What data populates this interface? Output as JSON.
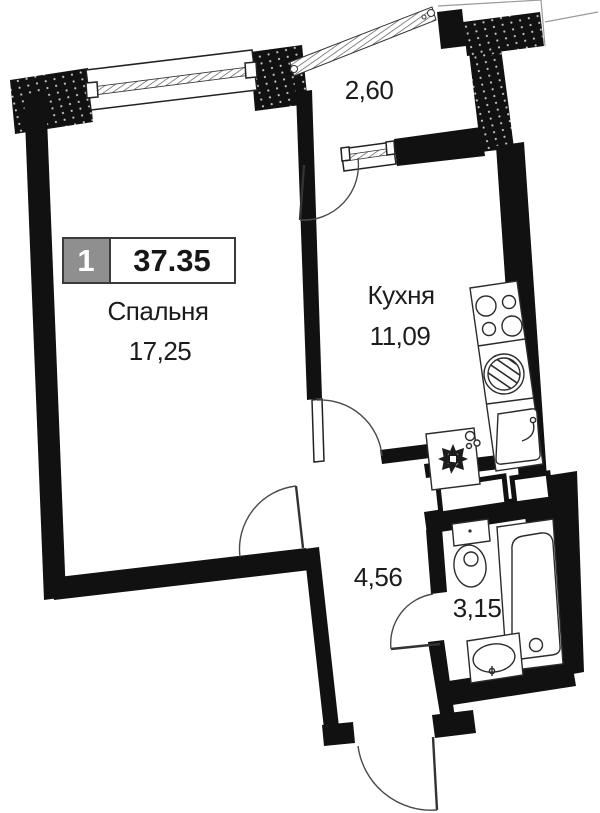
{
  "floor_plan": {
    "badge": {
      "room_count": "1",
      "total_area": "37.35"
    },
    "labels": {
      "bedroom_name": "Спальня",
      "bedroom_area": "17,25",
      "kitchen_name": "Кухня",
      "kitchen_area": "11,09",
      "balcony_area": "2,60",
      "hallway_area": "4,56",
      "bathroom_area": "3,15"
    },
    "colors": {
      "wall": "#111111",
      "text": "#1c1c1c",
      "badge_gray": "#8f8f8f",
      "background": "#ffffff"
    },
    "fixtures": [
      "stove",
      "washing-machine",
      "kitchen-sink",
      "fan",
      "toilet",
      "bathtub",
      "bathroom-sink"
    ]
  }
}
